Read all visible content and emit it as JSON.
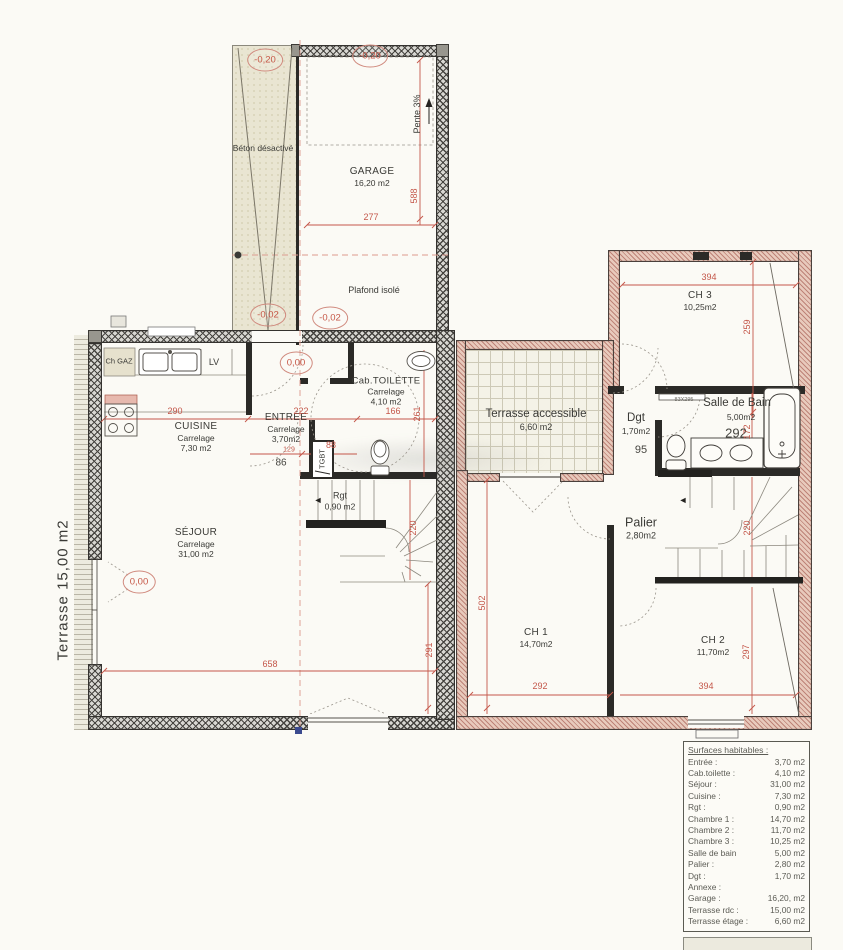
{
  "plan": {
    "ground": {
      "beton_label": "Béton désactivé",
      "level_beton": "-0,20",
      "level_garage": "-0,20",
      "level_m002a": "-0,02",
      "level_m002b": "-0,02",
      "level_zeroa": "0,00",
      "level_zerob": "0,00",
      "garage": {
        "name": "GARAGE",
        "area": "16,20 m2"
      },
      "pente": "Pente 3%",
      "plafond": "Plafond isolé",
      "ch_gaz": "Ch GAZ",
      "lv": "LV",
      "cuisine": {
        "name": "CUISINE",
        "finish": "Carrelage",
        "area": "7,30 m2"
      },
      "entree": {
        "name": "ENTRÉE",
        "finish": "Carrelage",
        "area": "3,70m2"
      },
      "tgbt": "TGBT",
      "cab": {
        "name": "Cab.TOILETTE",
        "finish": "Carrelage",
        "area": "4,10 m2"
      },
      "rgt": {
        "name": "Rgt",
        "area": "0,90 m2"
      },
      "sejour": {
        "name": "SÉJOUR",
        "finish": "Carrelage",
        "area": "31,00 m2"
      },
      "terrasse": "Terrasse 15,00 m2",
      "dims": {
        "d277": "277",
        "d588": "588",
        "d290": "290",
        "d222": "222",
        "d166": "166",
        "d261": "261",
        "d129": "129",
        "d88": "88",
        "d86": "86",
        "d220": "220",
        "d658": "658",
        "d291": "291"
      }
    },
    "upper": {
      "ch3": {
        "name": "CH 3",
        "area": "10,25m2"
      },
      "terrasse": {
        "name": "Terrasse accessible",
        "area": "6,60 m2"
      },
      "sdb": {
        "name": "Salle de Bain",
        "area": "5,00m2"
      },
      "dgt": {
        "name": "Dgt",
        "area": "1,70m2"
      },
      "palier": {
        "name": "Palier",
        "area": "2,80m2"
      },
      "ch1": {
        "name": "CH 1",
        "area": "14,70m2"
      },
      "ch2": {
        "name": "CH 2",
        "area": "11,70m2"
      },
      "closet": "83X295",
      "dims": {
        "d394t": "394",
        "d259": "259",
        "d292blk": "292",
        "d172": "172",
        "d95": "95",
        "d502": "502",
        "d220": "220",
        "d292": "292",
        "d394b": "394",
        "d297": "297"
      }
    }
  },
  "icons": {
    "rgt_arrow": "◄",
    "stairs_arrow": "◄"
  },
  "colors": {
    "dim_red": "#c4574a",
    "wall_dark": "#2b2a27",
    "wall_pink": "#e8cabc",
    "level_red": "#c65747"
  },
  "legend": {
    "title": "Surfaces habitables :",
    "rows": [
      {
        "label": "Entrée :",
        "value": "3,70 m2"
      },
      {
        "label": "Cab.toilette :",
        "value": "4,10 m2"
      },
      {
        "label": "Séjour :",
        "value": "31,00 m2"
      },
      {
        "label": "Cuisine :",
        "value": "7,30 m2"
      },
      {
        "label": "Rgt :",
        "value": "0,90 m2"
      },
      {
        "label": "Chambre 1 :",
        "value": "14,70 m2"
      },
      {
        "label": "Chambre 2 :",
        "value": "11,70 m2"
      },
      {
        "label": "Chambre 3 :",
        "value": "10,25 m2"
      },
      {
        "label": "Salle de bain",
        "value": "5,00 m2"
      },
      {
        "label": "Palier :",
        "value": "2,80 m2"
      },
      {
        "label": "Dgt :",
        "value": "1,70 m2"
      },
      {
        "label": "Annexe :",
        "value": ""
      },
      {
        "label": "Garage :",
        "value": "16,20, m2"
      },
      {
        "label": "Terrasse rdc :",
        "value": "15,00 m2"
      },
      {
        "label": "Terrasse étage :",
        "value": "6,60 m2"
      }
    ]
  }
}
